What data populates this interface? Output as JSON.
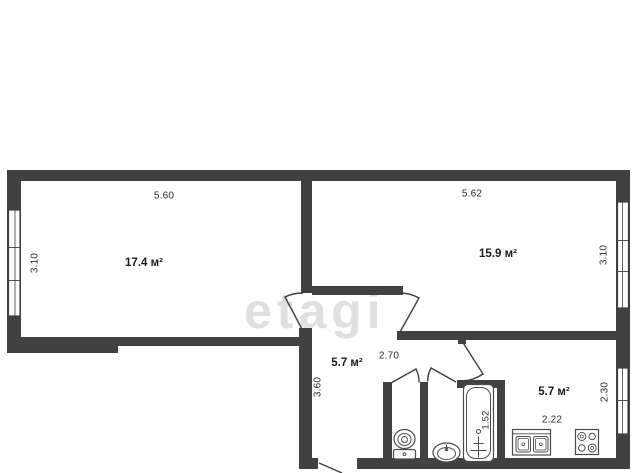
{
  "meta": {
    "type": "apartment-floor-plan",
    "language": "ru"
  },
  "watermark": {
    "text": "etagi",
    "color": "#e2dfe1"
  },
  "palette": {
    "wall": "#414141",
    "door_line": "#3f3f3f",
    "fixture_line": "#4c4c4c",
    "dim_text": "#2b2b2b",
    "area_text": "#1b1b1b",
    "background": "#ffffff"
  },
  "rooms": {
    "left": {
      "area": "17.4 м²",
      "width": "5.60",
      "depth": "3.10"
    },
    "right": {
      "area": "15.9 м²",
      "width": "5.62",
      "depth": "3.10"
    },
    "hallway": {
      "area": "5.7 м²",
      "width": "2.70",
      "depth": "3.60"
    },
    "kitchen": {
      "area": "5.7 м²",
      "width": "2.22",
      "depth": "2.30"
    },
    "bathroom": {
      "tub_length": "1.52"
    }
  },
  "fixtures": [
    "toilet",
    "wash-basin",
    "bathtub",
    "kitchen-sink",
    "stove"
  ],
  "counts": {
    "windows": 3,
    "doors": 6
  }
}
